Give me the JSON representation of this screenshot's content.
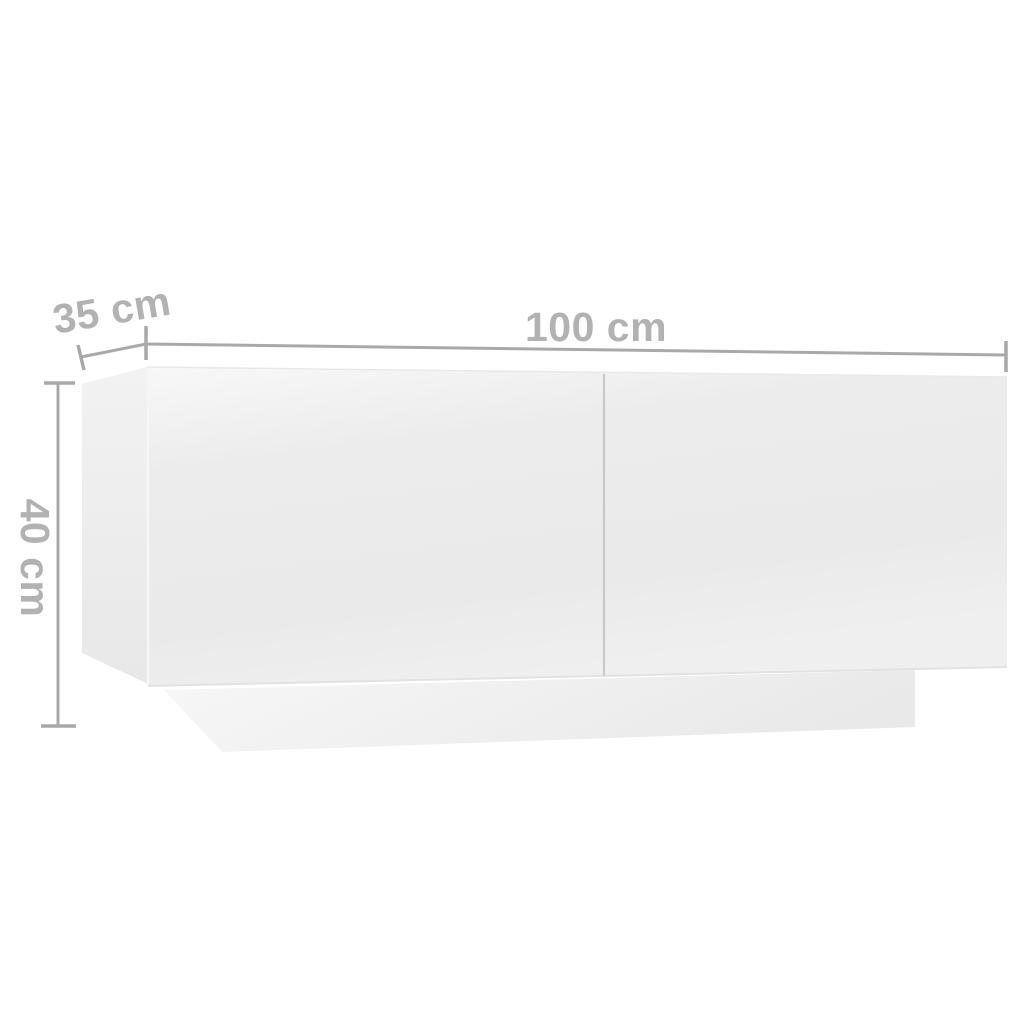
{
  "diagram": {
    "type": "furniture-dimension-diagram",
    "dimension_labels": {
      "width": "100 cm",
      "depth": "35 cm",
      "height": "40 cm"
    },
    "colors": {
      "background": "#ffffff",
      "dimension_line": "#a9a9a9",
      "dimension_label_text": "#b2b2b2",
      "cabinet_front_face": "#ececec",
      "cabinet_front_sheen": "#f7f7f7",
      "cabinet_side_face": "#eaeaea",
      "plinth_face": "#efefef",
      "door_divider_line": "#c9c9c9"
    }
  }
}
